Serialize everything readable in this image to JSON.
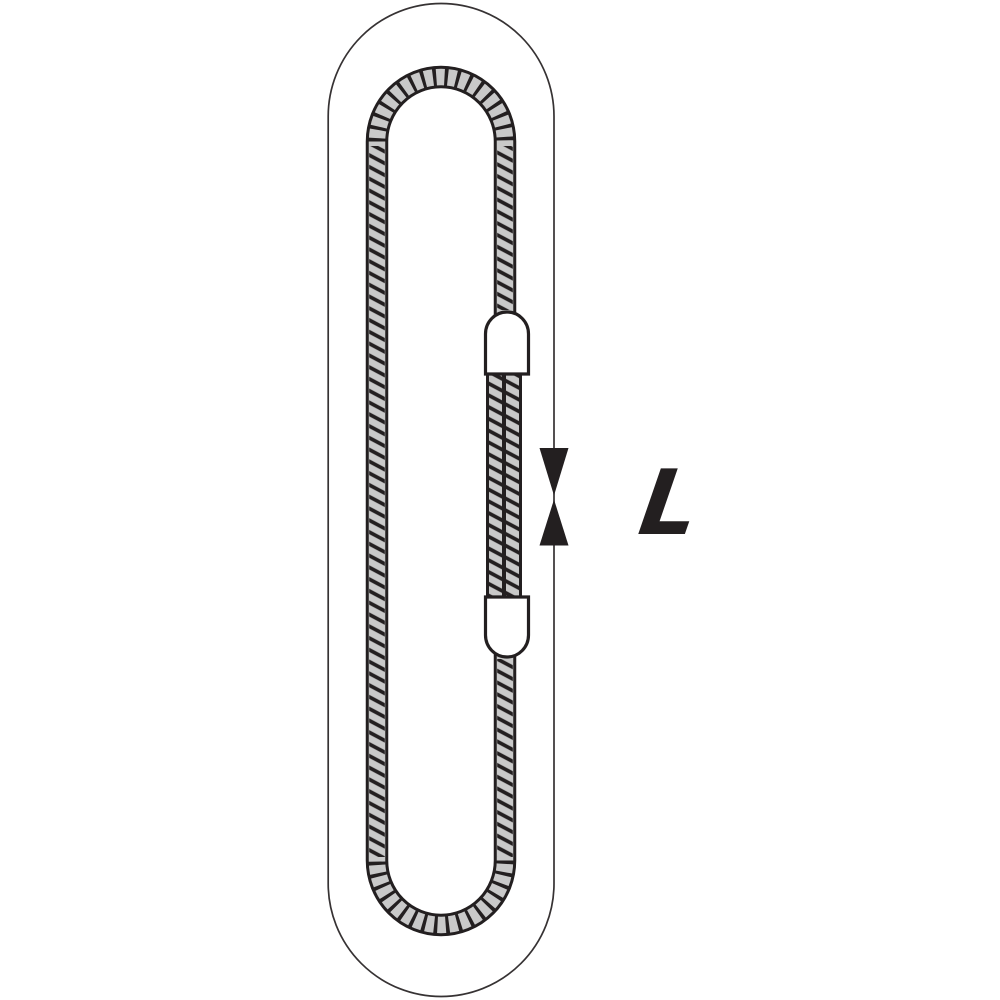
{
  "diagram": {
    "dimension": {
      "label": "L",
      "marker_upper": "arrow-down-icon",
      "marker_lower": "arrow-up-icon"
    },
    "parts": {
      "outline": "capsule-outline",
      "rope": "endless-rope-loop",
      "splice": "doubled-rope-section",
      "ferrule_top": "pressed-ferrule",
      "ferrule_bottom": "pressed-ferrule"
    },
    "colors": {
      "line": "#231f20",
      "thin_outline": "#363233",
      "rope_fill": "#c9c9c9",
      "ferrule_fill": "#ffffff",
      "background": "#ffffff"
    }
  }
}
